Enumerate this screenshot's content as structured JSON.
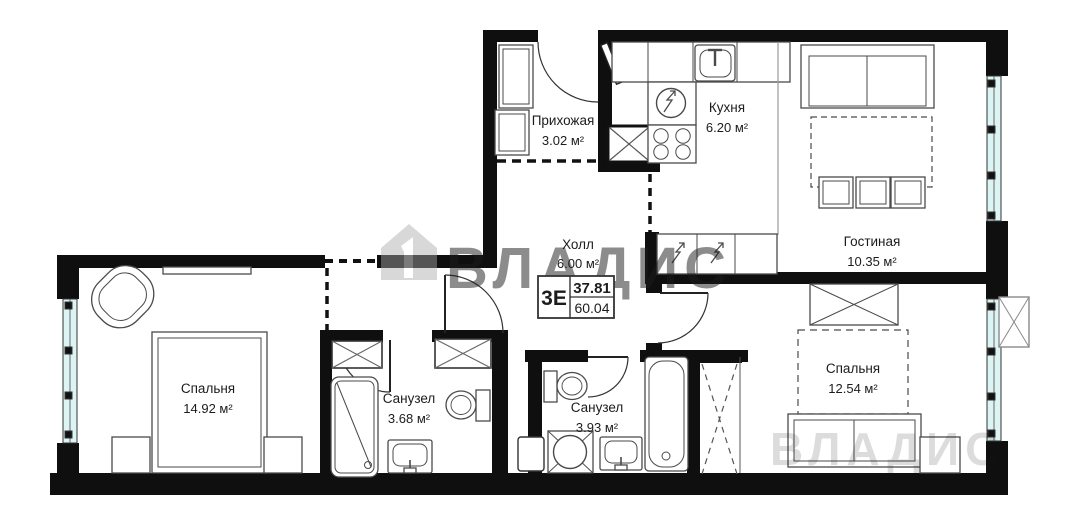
{
  "plan": {
    "watermark": {
      "text": "ВЛАДИС"
    },
    "summary": {
      "unit_type": "3Е",
      "living_area": "37.81",
      "total_area": "60.04"
    },
    "rooms": [
      {
        "id": "hallway",
        "name": "Прихожая",
        "area": "3.02 м²"
      },
      {
        "id": "kitchen",
        "name": "Кухня",
        "area": "6.20 м²"
      },
      {
        "id": "living-room",
        "name": "Гостиная",
        "area": "10.35 м²"
      },
      {
        "id": "hall",
        "name": "Холл",
        "area": "6.00 м²"
      },
      {
        "id": "bedroom-left",
        "name": "Спальня",
        "area": "14.92 м²"
      },
      {
        "id": "bathroom-1",
        "name": "Санузел",
        "area": "3.68 м²"
      },
      {
        "id": "bathroom-2",
        "name": "Санузел",
        "area": "3.93 м²"
      },
      {
        "id": "bedroom-right",
        "name": "Спальня",
        "area": "12.54 м²"
      }
    ],
    "colors": {
      "wall": "#0f0f0f",
      "window_glass": "#ddf4f4",
      "watermark": "#a8a8a8",
      "furniture_outline": "#4a4a4a"
    }
  }
}
